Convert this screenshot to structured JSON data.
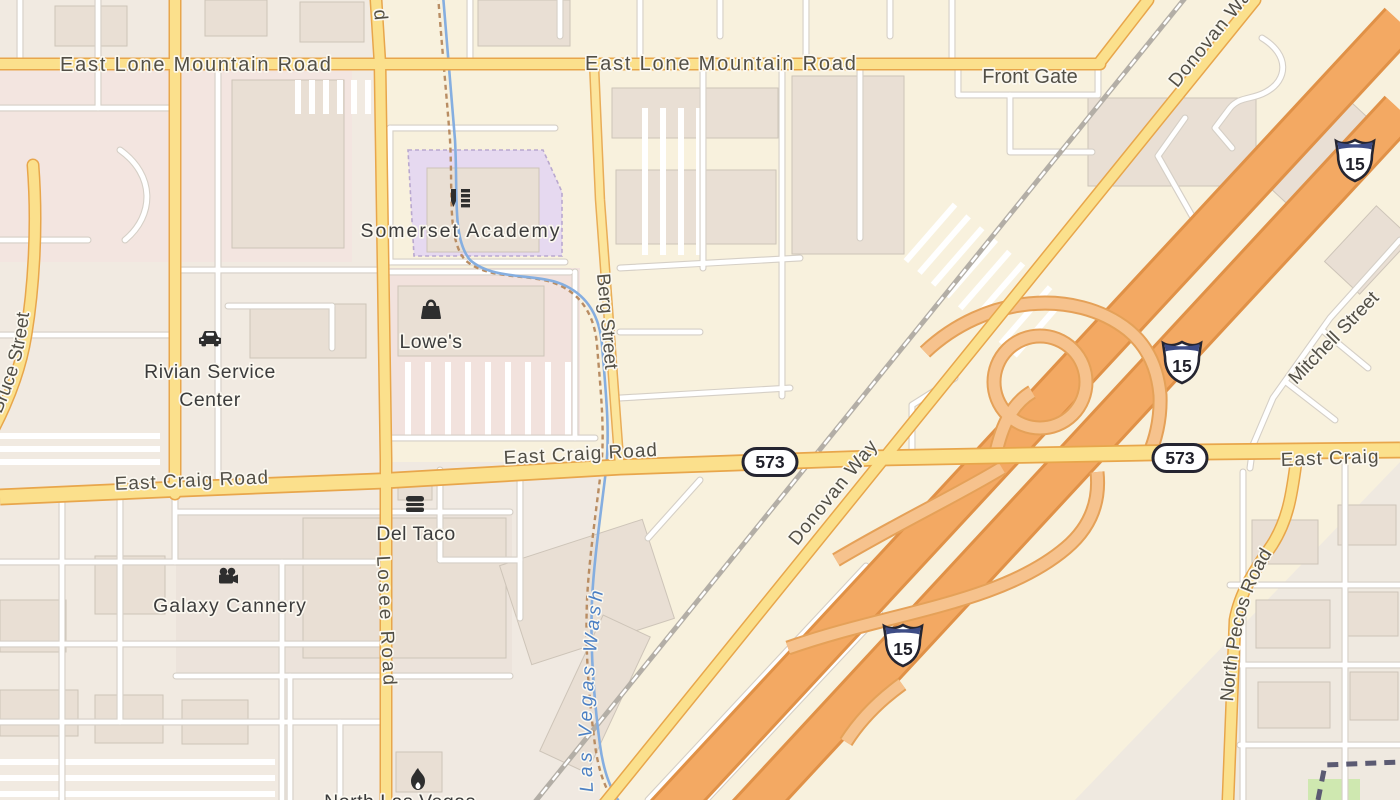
{
  "map": {
    "labels": {
      "east_lone_mountain_road_1": "East Lone Mountain Road",
      "east_lone_mountain_road_2": "East Lone Mountain Road",
      "front_gate": "Front Gate",
      "donovan_way_north": "Donovan Way",
      "donovan_way_south": "Donovan Way",
      "berg_street": "Berg Street",
      "losee_road": "Losee Road",
      "east_craig_road_west": "East Craig Road",
      "east_craig_road_center": "East Craig Road",
      "east_craig_road_east": "East Craig",
      "north_bruce_street": "North Bruce Street",
      "north_pecos_road": "North Pecos Road",
      "mitchell_street": "Mitchell Street",
      "las_vegas_wash": "Las Vegas Wash",
      "road_label_fragment_top": "d",
      "poi_label_fragment_bottom": "North Las Vegas"
    },
    "pois": {
      "somerset_academy": {
        "label": "Somerset Academy",
        "icon": "school-icon"
      },
      "lowes": {
        "label": "Lowe's",
        "icon": "shopping-bag-icon"
      },
      "rivian_service_center": {
        "label_line1": "Rivian Service",
        "label_line2": "Center",
        "icon": "car-icon"
      },
      "del_taco": {
        "label": "Del Taco",
        "icon": "burger-icon"
      },
      "galaxy_cannery": {
        "label": "Galaxy Cannery",
        "icon": "movie-camera-icon"
      },
      "fire_station": {
        "icon": "fire-icon"
      }
    },
    "shields": {
      "interstate_15": {
        "number": "15"
      },
      "nevada_573": {
        "number": "573"
      }
    },
    "colors": {
      "background": "#f8f1dd",
      "residential_zone": "#f1eae1",
      "retail_zone_pink": "#f3e5e0",
      "school_zone": "#e6d9f0",
      "building": "#e9dfd4",
      "road_minor": "#ffffff",
      "road_secondary_fill": "#fbe08c",
      "road_secondary_casing": "#e8a64b",
      "motorway_fill": "#f3a963",
      "motorway_casing": "#e09147",
      "ramp_fill": "#f6c28d",
      "railway": "#b3aea6",
      "water": "#85aee0",
      "water_label": "#4c80c4",
      "road_label": "#524f46",
      "poi_label": "#3c3c3c",
      "shield_blue_band": "#3d4c86",
      "grass": "#cfe8b0",
      "boundary": "#5b5a72"
    }
  }
}
